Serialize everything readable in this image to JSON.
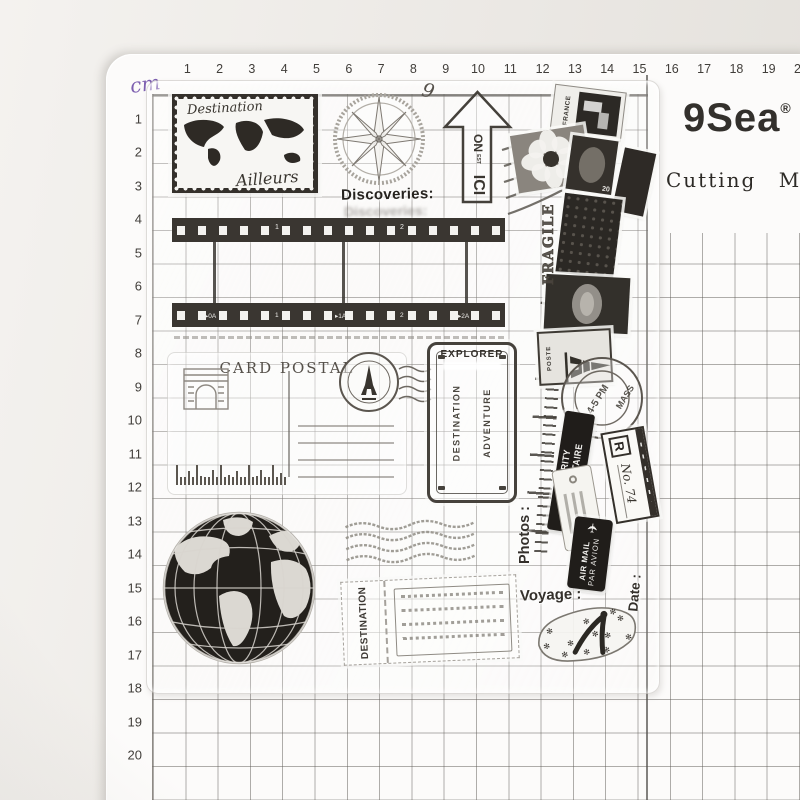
{
  "scene": {
    "bg": "#ece9e5",
    "mat_bg": "#fcfbfa",
    "grid_line": "#8d8a84",
    "purple": "#7d5fb0",
    "ink": "#33302c",
    "stamp_dark": "#34302b"
  },
  "mat": {
    "brand": "9Sea",
    "registered_mark": "®",
    "product": "Cutting Mat",
    "unit": "cm",
    "ruler_top": [
      "1",
      "2",
      "3",
      "4",
      "5",
      "6",
      "7",
      "8",
      "9",
      "10",
      "11",
      "12",
      "13",
      "14",
      "15",
      "16",
      "17",
      "18",
      "19",
      "20"
    ],
    "ruler_left": [
      "1",
      "2",
      "3",
      "4",
      "5",
      "6",
      "7",
      "8",
      "9",
      "10",
      "11",
      "12",
      "13",
      "14",
      "15",
      "16",
      "17",
      "18",
      "19",
      "20"
    ]
  },
  "sheet": {
    "postage_stamp": {
      "line1": "Destination",
      "line2": "Ailleurs",
      "icon": "world-map-icon"
    },
    "compass": {
      "icon": "compass-rose-icon"
    },
    "handwritten_mark": "9",
    "arrow": {
      "icon": "up-arrow-icon",
      "word1": "ON",
      "word2": "EST",
      "word3": "ICI"
    },
    "discoveries": "Discoveries:",
    "film": {
      "icon": "film-strip-icon",
      "frame_numbers_top": [
        "1",
        "2"
      ],
      "frame_marks_bottom": [
        "▸0A",
        "1",
        "▸1A",
        "2",
        "▸2A"
      ]
    },
    "postcard": {
      "title": "CARD POSTAL",
      "icon": "postcard-icon"
    },
    "explorer": {
      "title": "EXPLORER",
      "left": "DESTINATION",
      "right": "ADVENTURE"
    },
    "cluster": {
      "france": "FRANCE",
      "stamp_value": "20",
      "fragile": "FRAGILE",
      "poste": "POSTE",
      "postmark_line1": "4-5 PM",
      "postmark_line2": "MASS"
    },
    "priority": {
      "line1": "PRIORITY",
      "line2": "PRIORITAIRE"
    },
    "registered": {
      "letter": "R",
      "number": "No. 74"
    },
    "airmail": {
      "icon": "airplane-icon",
      "plane": "✈",
      "line1": "AIR MAIL",
      "line2": "PAR AVION"
    },
    "labels": {
      "photos": "Photos :",
      "voyage": "Voyage :",
      "date": "Date :"
    },
    "ticket": {
      "label": "DESTINATION"
    },
    "globe": {
      "icon": "globe-icon"
    },
    "flipflop": {
      "icon": "flip-flop-icon",
      "pattern_glyph": "✻"
    }
  }
}
